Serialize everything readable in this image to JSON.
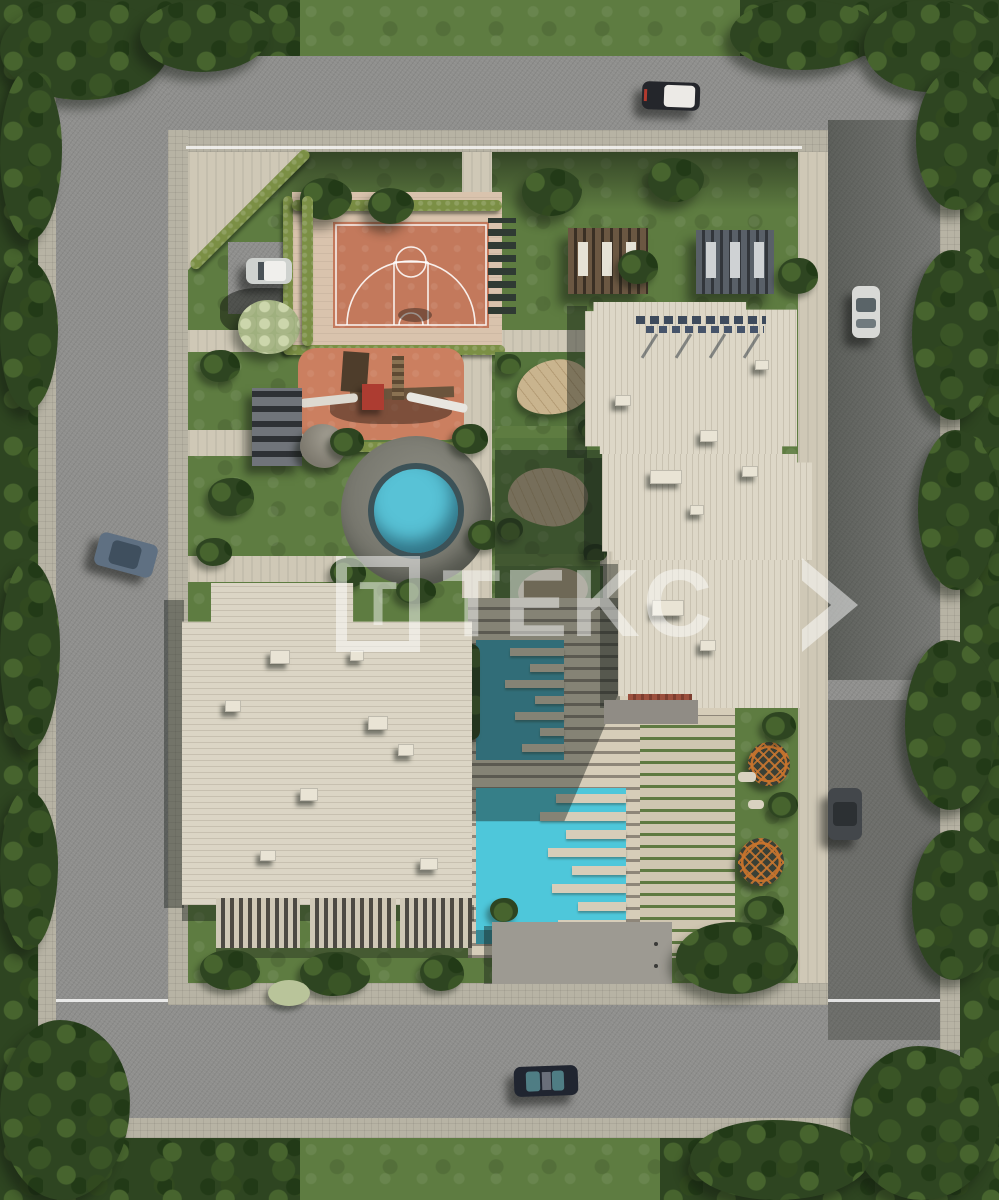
{
  "title": "Aerial 3D render of a residential complex site plan",
  "watermark": {
    "logo_letter": "T",
    "text": "TEKC"
  },
  "palette": {
    "road": "#8f8f8d",
    "sidewalk": "#b7b3a4",
    "grass": "#5e7c41",
    "trees_dark": "#2e4521",
    "roof": "#ddd7c7",
    "court_terracotta": "#c3795c",
    "playground_terracotta": "#cb7f60",
    "pool_turquoise": "#4ec7da",
    "deck_beige": "#d6cdb9",
    "hedge_green": "#7b8f45",
    "dome_orange": "#c8732c",
    "brick_red": "#9b4f3d",
    "watermark_white": "rgba(255,255,255,0.47)"
  }
}
